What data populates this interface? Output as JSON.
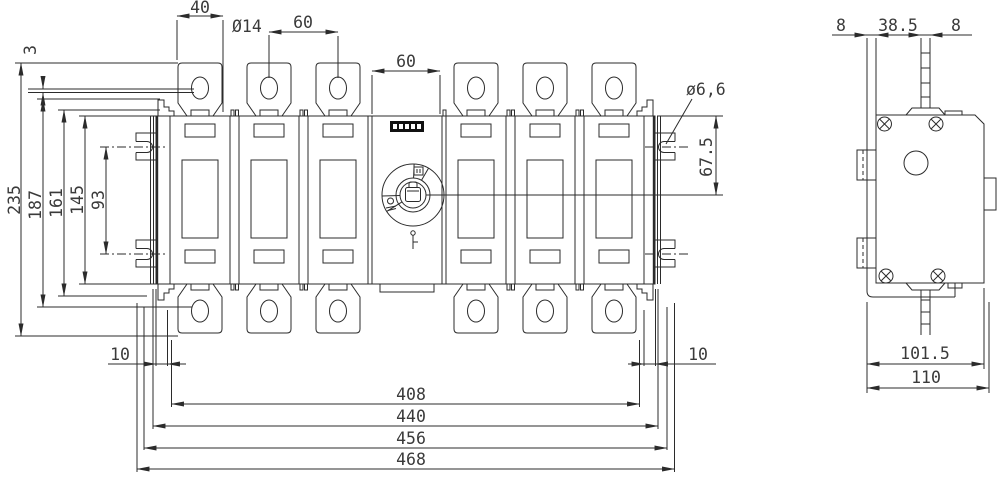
{
  "colors": {
    "line": "#2b2b2b",
    "background": "#ffffff",
    "label_bg": "#111111"
  },
  "dims": {
    "top_tab_width": "40",
    "hole_diameter": "Ø14",
    "pole_pitch": "60",
    "module_width": "60",
    "busbar_thickness": "3",
    "height_overall": "235",
    "height_tabs": "187",
    "height_161": "161",
    "height_body": "145",
    "slot_span": "93",
    "offset_left": "10",
    "offset_right": "10",
    "span_408": "408",
    "span_440": "440",
    "span_456": "456",
    "span_468": "468",
    "slot_diameter": "ø6,6",
    "handle_offset": "67.5",
    "side_8_left": "8",
    "side_38_5": "38.5",
    "side_8_right": "8",
    "side_101_5": "101.5",
    "side_110": "110"
  }
}
